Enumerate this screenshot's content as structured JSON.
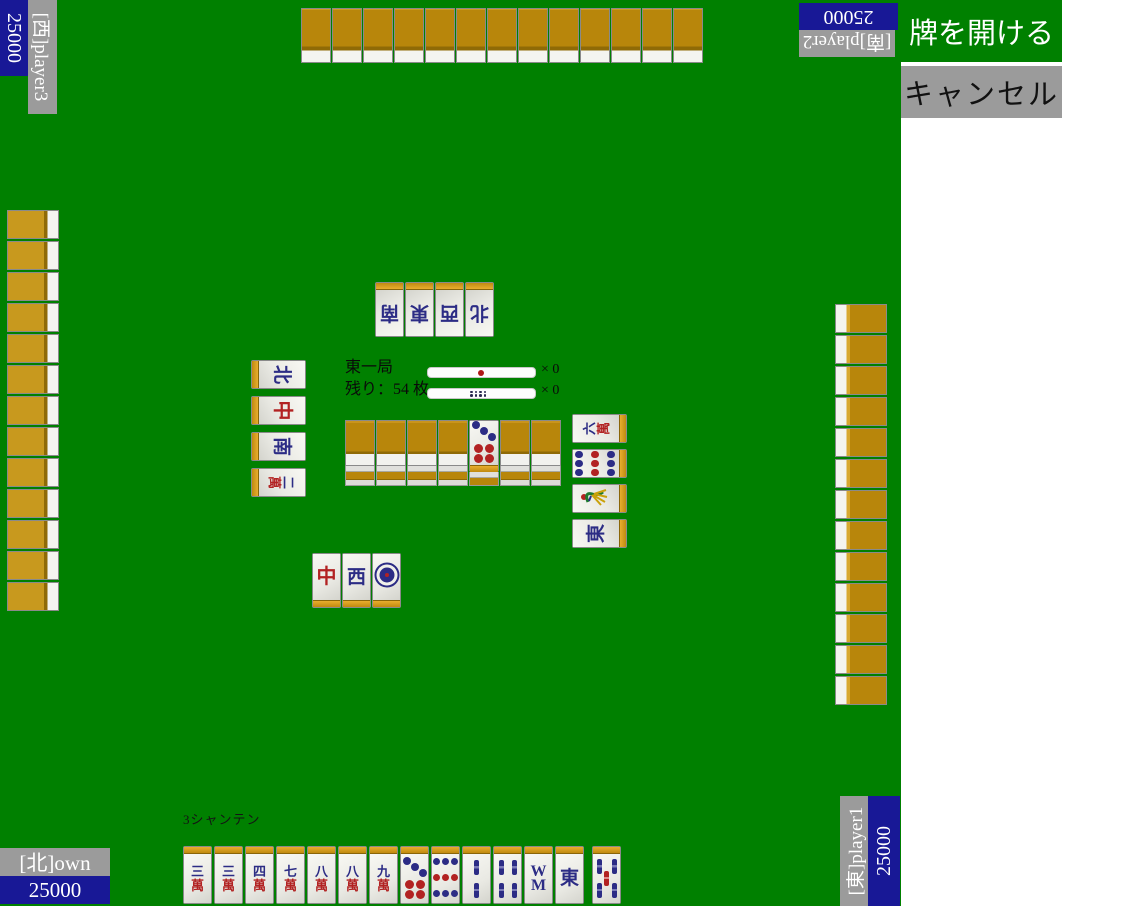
{
  "buttons": {
    "open_label": "牌を開ける",
    "cancel_label": "キャンセル"
  },
  "players": {
    "west": {
      "label": "[西]player3",
      "score": "25000"
    },
    "south": {
      "label": "[南]player2",
      "score": "25000"
    },
    "own": {
      "label": "[北]own",
      "score": "25000"
    },
    "east": {
      "label": "[東]player1",
      "score": "25000"
    }
  },
  "center_panel": {
    "round": "東一局",
    "remaining": "残り：54 枚",
    "riichi_sticks_label": "× 0",
    "honba_sticks_label": "× 0"
  },
  "status": {
    "shanten": "3シャンテン"
  },
  "hand": {
    "tiles": [
      "3m",
      "3m",
      "4m",
      "7m",
      "8m",
      "8m",
      "9m",
      "7p",
      "9p",
      "2s",
      "4s",
      "8s",
      "E"
    ],
    "drawn": "5s"
  },
  "discards": {
    "south": [
      "S",
      "E",
      "W",
      "N"
    ],
    "west": [
      "N",
      "C",
      "S",
      "2m"
    ],
    "east": [
      "6m",
      "9p",
      "1s",
      "E"
    ],
    "own": [
      "C",
      "W",
      "1p"
    ]
  },
  "wall": {
    "stacks": 7,
    "dora_position": 5,
    "dora_tile": "7p"
  },
  "hidden_hands": {
    "top_count": 13,
    "left_count": 13,
    "right_count": 13
  },
  "glyphs": {
    "man": {
      "2": "二",
      "3": "三",
      "4": "四",
      "5": "五",
      "6": "六",
      "7": "七",
      "8": "八",
      "9": "九"
    },
    "winds": {
      "E": "東",
      "S": "南",
      "W": "西",
      "N": "北"
    },
    "dragons": {
      "C": "中"
    },
    "man_suit": "萬",
    "sou8": [
      "W",
      "M"
    ]
  },
  "colors": {
    "table": "#008000",
    "score_box": "#181896",
    "label_box": "#9b9b9b",
    "tile_back": "#b8860b",
    "glyph_navy": "#2c2c85",
    "glyph_red": "#b22222",
    "button_green": "#008000",
    "button_gray": "#9b9b9b"
  }
}
